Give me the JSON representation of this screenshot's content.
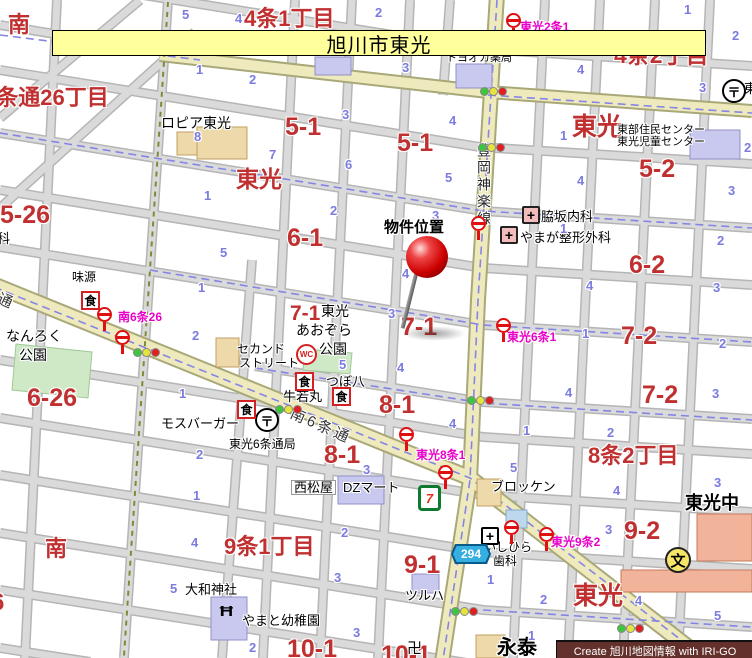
{
  "banner": {
    "title": "旭川市東光"
  },
  "credit_text": "Create 旭川地図情報 with IRI-GO",
  "marker": {
    "label": "物件位置"
  },
  "colors": {
    "area_red": "#c03030",
    "lot_blue": "#7b7be0",
    "busstop_magenta": "#e800c8",
    "banner_bg": "#ffff9c",
    "credit_bg": "#63302b",
    "road_yellow": "#efeabd"
  },
  "labels": [
    {
      "c": "red",
      "t": "南",
      "x": 8,
      "y": 14,
      "s": 22
    },
    {
      "c": "red",
      "t": "4条1丁目",
      "x": 244,
      "y": 8,
      "s": 22
    },
    {
      "c": "red",
      "t": "4条2丁目",
      "x": 614,
      "y": 44,
      "s": 23
    },
    {
      "c": "red",
      "t": "4条通26丁目",
      "x": -16,
      "y": 87,
      "s": 22
    },
    {
      "c": "red",
      "t": "5-26",
      "x": 0,
      "y": 203,
      "s": 25
    },
    {
      "c": "red",
      "t": "東光",
      "x": 236,
      "y": 168,
      "s": 23
    },
    {
      "c": "red",
      "t": "東光",
      "x": 572,
      "y": 115,
      "s": 25
    },
    {
      "c": "red",
      "t": "5-1",
      "x": 285,
      "y": 115,
      "s": 25
    },
    {
      "c": "red",
      "t": "5-1",
      "x": 397,
      "y": 131,
      "s": 25
    },
    {
      "c": "red",
      "t": "5-2",
      "x": 639,
      "y": 157,
      "s": 25
    },
    {
      "c": "red",
      "t": "6-1",
      "x": 287,
      "y": 226,
      "s": 25
    },
    {
      "c": "red",
      "t": "6-2",
      "x": 629,
      "y": 253,
      "s": 25
    },
    {
      "c": "red",
      "t": "6-26",
      "x": 27,
      "y": 386,
      "s": 25
    },
    {
      "c": "red",
      "t": "7-1",
      "x": 290,
      "y": 303,
      "s": 21
    },
    {
      "c": "red",
      "t": "7-1",
      "x": 401,
      "y": 315,
      "s": 25
    },
    {
      "c": "red",
      "t": "7-2",
      "x": 621,
      "y": 324,
      "s": 25
    },
    {
      "c": "red",
      "t": "7-2",
      "x": 642,
      "y": 383,
      "s": 25
    },
    {
      "c": "red",
      "t": "8-1",
      "x": 379,
      "y": 393,
      "s": 25
    },
    {
      "c": "red",
      "t": "8-1",
      "x": 324,
      "y": 443,
      "s": 25
    },
    {
      "c": "red",
      "t": "8条2丁目",
      "x": 588,
      "y": 445,
      "s": 22
    },
    {
      "c": "red",
      "t": "9条1丁目",
      "x": 224,
      "y": 536,
      "s": 22
    },
    {
      "c": "red",
      "t": "9-1",
      "x": 404,
      "y": 553,
      "s": 25
    },
    {
      "c": "red",
      "t": "9-2",
      "x": 624,
      "y": 519,
      "s": 25
    },
    {
      "c": "red",
      "t": "南",
      "x": 45,
      "y": 538,
      "s": 22
    },
    {
      "c": "red",
      "t": "東光",
      "x": 573,
      "y": 584,
      "s": 25
    },
    {
      "c": "red",
      "t": "10-1",
      "x": 287,
      "y": 637,
      "s": 25
    },
    {
      "c": "red",
      "t": "10-1",
      "x": 381,
      "y": 643,
      "s": 25
    },
    {
      "c": "red",
      "t": "6",
      "x": -9,
      "y": 591,
      "s": 24
    },
    {
      "c": "mag",
      "t": "東光2条1",
      "x": 520,
      "y": 21,
      "s": 12
    },
    {
      "c": "mag",
      "t": "南6条26",
      "x": 118,
      "y": 311,
      "s": 12
    },
    {
      "c": "mag",
      "t": "東光6条1",
      "x": 507,
      "y": 331,
      "s": 12
    },
    {
      "c": "mag",
      "t": "東光8条1",
      "x": 416,
      "y": 449,
      "s": 12
    },
    {
      "c": "mag",
      "t": "東光9条2",
      "x": 551,
      "y": 536,
      "s": 12
    },
    {
      "c": "poi",
      "t": "トヨオカ薬局",
      "x": 446,
      "y": 53,
      "s": 11
    },
    {
      "c": "poi",
      "t": "ロピア東光",
      "x": 161,
      "y": 116,
      "s": 14
    },
    {
      "c": "poi",
      "t": "東部住民センター",
      "x": 617,
      "y": 125,
      "s": 11
    },
    {
      "c": "poi",
      "t": "東光児童センター",
      "x": 617,
      "y": 137,
      "s": 11
    },
    {
      "c": "poi",
      "t": "脇坂内科",
      "x": 541,
      "y": 210,
      "s": 13
    },
    {
      "c": "poi",
      "t": "やまが整形外科",
      "x": 520,
      "y": 231,
      "s": 13
    },
    {
      "c": "poi",
      "t": "味源",
      "x": 72,
      "y": 271,
      "s": 12
    },
    {
      "c": "poi",
      "t": "なんろく",
      "x": 6,
      "y": 329,
      "s": 14
    },
    {
      "c": "poi",
      "t": "公園",
      "x": 19,
      "y": 348,
      "s": 14
    },
    {
      "c": "poi",
      "t": "東光",
      "x": 321,
      "y": 304,
      "s": 14
    },
    {
      "c": "poi",
      "t": "あおぞら",
      "x": 296,
      "y": 323,
      "s": 14
    },
    {
      "c": "poi",
      "t": "公園",
      "x": 319,
      "y": 342,
      "s": 14
    },
    {
      "c": "poi",
      "t": "セカンド",
      "x": 237,
      "y": 343,
      "s": 12
    },
    {
      "c": "poi",
      "t": "ストリート",
      "x": 239,
      "y": 357,
      "s": 12
    },
    {
      "c": "poi",
      "t": "つぼ八",
      "x": 326,
      "y": 375,
      "s": 13
    },
    {
      "c": "poi",
      "t": "牛若丸",
      "x": 283,
      "y": 390,
      "s": 13
    },
    {
      "c": "poi",
      "t": "モスバーガー",
      "x": 161,
      "y": 417,
      "s": 13
    },
    {
      "c": "poi",
      "t": "東光6条通局",
      "x": 229,
      "y": 438,
      "s": 12
    },
    {
      "c": "poi boxed",
      "t": "西松屋",
      "x": 291,
      "y": 480,
      "s": 13
    },
    {
      "c": "poi",
      "t": "DZマート",
      "x": 343,
      "y": 481,
      "s": 13
    },
    {
      "c": "poi",
      "t": "ブロッケン",
      "x": 491,
      "y": 480,
      "s": 13
    },
    {
      "c": "poi",
      "t": "いしひら",
      "x": 484,
      "y": 541,
      "s": 12
    },
    {
      "c": "poi",
      "t": "歯科",
      "x": 493,
      "y": 555,
      "s": 12
    },
    {
      "c": "poib",
      "t": "東光中",
      "x": 685,
      "y": 494,
      "s": 18
    },
    {
      "c": "poi",
      "t": "ツルハ",
      "x": 405,
      "y": 589,
      "s": 13
    },
    {
      "c": "poi",
      "t": "大和神社",
      "x": 185,
      "y": 583,
      "s": 13
    },
    {
      "c": "poi",
      "t": "やまと幼稚園",
      "x": 242,
      "y": 614,
      "s": 13
    },
    {
      "c": "poib",
      "t": "永泰",
      "x": 497,
      "y": 638,
      "s": 20
    },
    {
      "c": "poi",
      "t": "卍",
      "x": 407,
      "y": 641,
      "s": 15
    },
    {
      "c": "poi",
      "t": "科",
      "x": -3,
      "y": 232,
      "s": 13
    },
    {
      "c": "poi",
      "t": "東",
      "x": 744,
      "y": 82,
      "s": 13
    },
    {
      "c": "vroad",
      "t": "豊岡神楽線",
      "x": 477,
      "y": 143,
      "s": 14
    },
    {
      "c": "droad",
      "t": "南6条通",
      "x": 294,
      "y": 406,
      "s": 15,
      "r": 24
    },
    {
      "c": "droad",
      "t": "通",
      "x": 1,
      "y": 291,
      "s": 15,
      "r": 24
    },
    {
      "c": "blue",
      "t": "5",
      "x": 182,
      "y": 8,
      "s": 13
    },
    {
      "c": "blue",
      "t": "4",
      "x": 235,
      "y": 12,
      "s": 13
    },
    {
      "c": "blue",
      "t": "2",
      "x": 375,
      "y": 6,
      "s": 13
    },
    {
      "c": "blue",
      "t": "1",
      "x": 196,
      "y": 63,
      "s": 13
    },
    {
      "c": "blue",
      "t": "2",
      "x": 249,
      "y": 73,
      "s": 13
    },
    {
      "c": "blue",
      "t": "3",
      "x": 402,
      "y": 61,
      "s": 13
    },
    {
      "c": "blue",
      "t": "1",
      "x": 684,
      "y": 3,
      "s": 13
    },
    {
      "c": "blue",
      "t": "2",
      "x": 732,
      "y": 29,
      "s": 13
    },
    {
      "c": "blue",
      "t": "4",
      "x": 577,
      "y": 63,
      "s": 13
    },
    {
      "c": "blue",
      "t": "3",
      "x": 699,
      "y": 81,
      "s": 13
    },
    {
      "c": "blue",
      "t": "8",
      "x": 194,
      "y": 130,
      "s": 13
    },
    {
      "c": "blue",
      "t": "1",
      "x": 204,
      "y": 189,
      "s": 13
    },
    {
      "c": "blue",
      "t": "3",
      "x": 342,
      "y": 108,
      "s": 13
    },
    {
      "c": "blue",
      "t": "4",
      "x": 449,
      "y": 114,
      "s": 13
    },
    {
      "c": "blue",
      "t": "7",
      "x": 269,
      "y": 148,
      "s": 13
    },
    {
      "c": "blue",
      "t": "6",
      "x": 345,
      "y": 158,
      "s": 13
    },
    {
      "c": "blue",
      "t": "5",
      "x": 445,
      "y": 171,
      "s": 13
    },
    {
      "c": "blue",
      "t": "2",
      "x": 330,
      "y": 204,
      "s": 13
    },
    {
      "c": "blue",
      "t": "3",
      "x": 432,
      "y": 209,
      "s": 13
    },
    {
      "c": "blue",
      "t": "1",
      "x": 560,
      "y": 129,
      "s": 13
    },
    {
      "c": "blue",
      "t": "2",
      "x": 744,
      "y": 141,
      "s": 13
    },
    {
      "c": "blue",
      "t": "4",
      "x": 577,
      "y": 174,
      "s": 13
    },
    {
      "c": "blue",
      "t": "3",
      "x": 728,
      "y": 184,
      "s": 13
    },
    {
      "c": "blue",
      "t": "5",
      "x": 220,
      "y": 246,
      "s": 13
    },
    {
      "c": "blue",
      "t": "1",
      "x": 198,
      "y": 281,
      "s": 13
    },
    {
      "c": "blue",
      "t": "2",
      "x": 192,
      "y": 329,
      "s": 13
    },
    {
      "c": "blue",
      "t": "4",
      "x": 402,
      "y": 267,
      "s": 13
    },
    {
      "c": "blue",
      "t": "3",
      "x": 388,
      "y": 307,
      "s": 13
    },
    {
      "c": "blue",
      "t": "1",
      "x": 560,
      "y": 222,
      "s": 13
    },
    {
      "c": "blue",
      "t": "2",
      "x": 717,
      "y": 234,
      "s": 13
    },
    {
      "c": "blue",
      "t": "4",
      "x": 586,
      "y": 279,
      "s": 13
    },
    {
      "c": "blue",
      "t": "3",
      "x": 713,
      "y": 281,
      "s": 13
    },
    {
      "c": "blue",
      "t": "1",
      "x": 582,
      "y": 327,
      "s": 13
    },
    {
      "c": "blue",
      "t": "5",
      "x": 339,
      "y": 358,
      "s": 13
    },
    {
      "c": "blue",
      "t": "4",
      "x": 397,
      "y": 361,
      "s": 13
    },
    {
      "c": "blue",
      "t": "4",
      "x": 449,
      "y": 417,
      "s": 13
    },
    {
      "c": "blue",
      "t": "1",
      "x": 179,
      "y": 387,
      "s": 13
    },
    {
      "c": "blue",
      "t": "2",
      "x": 196,
      "y": 448,
      "s": 13
    },
    {
      "c": "blue",
      "t": "2",
      "x": 719,
      "y": 337,
      "s": 13
    },
    {
      "c": "blue",
      "t": "4",
      "x": 565,
      "y": 386,
      "s": 13
    },
    {
      "c": "blue",
      "t": "3",
      "x": 712,
      "y": 387,
      "s": 13
    },
    {
      "c": "blue",
      "t": "1",
      "x": 523,
      "y": 424,
      "s": 13
    },
    {
      "c": "blue",
      "t": "2",
      "x": 607,
      "y": 426,
      "s": 13
    },
    {
      "c": "blue",
      "t": "5",
      "x": 510,
      "y": 461,
      "s": 13
    },
    {
      "c": "blue",
      "t": "3",
      "x": 363,
      "y": 463,
      "s": 13
    },
    {
      "c": "blue",
      "t": "2",
      "x": 341,
      "y": 526,
      "s": 13
    },
    {
      "c": "blue",
      "t": "3",
      "x": 334,
      "y": 571,
      "s": 13
    },
    {
      "c": "blue",
      "t": "1",
      "x": 487,
      "y": 573,
      "s": 13
    },
    {
      "c": "blue",
      "t": "4",
      "x": 613,
      "y": 484,
      "s": 13
    },
    {
      "c": "blue",
      "t": "3",
      "x": 714,
      "y": 476,
      "s": 13
    },
    {
      "c": "blue",
      "t": "3",
      "x": 605,
      "y": 523,
      "s": 13
    },
    {
      "c": "blue",
      "t": "1",
      "x": 193,
      "y": 489,
      "s": 13
    },
    {
      "c": "blue",
      "t": "4",
      "x": 191,
      "y": 536,
      "s": 13
    },
    {
      "c": "blue",
      "t": "5",
      "x": 170,
      "y": 582,
      "s": 13
    },
    {
      "c": "blue",
      "t": "2",
      "x": 249,
      "y": 641,
      "s": 13
    },
    {
      "c": "blue",
      "t": "3",
      "x": 353,
      "y": 626,
      "s": 13
    },
    {
      "c": "blue",
      "t": "2",
      "x": 540,
      "y": 593,
      "s": 13
    },
    {
      "c": "blue",
      "t": "4",
      "x": 635,
      "y": 594,
      "s": 13
    },
    {
      "c": "blue",
      "t": "5",
      "x": 714,
      "y": 609,
      "s": 13
    },
    {
      "c": "blue",
      "t": "1",
      "x": 528,
      "y": 629,
      "s": 13
    }
  ],
  "icons": [
    {
      "k": "bus",
      "x": 506,
      "y": 13
    },
    {
      "k": "bus",
      "x": 97,
      "y": 307
    },
    {
      "k": "bus",
      "x": 115,
      "y": 330
    },
    {
      "k": "bus",
      "x": 496,
      "y": 318
    },
    {
      "k": "bus",
      "x": 399,
      "y": 427
    },
    {
      "k": "bus",
      "x": 438,
      "y": 465
    },
    {
      "k": "bus",
      "x": 539,
      "y": 527
    },
    {
      "k": "bus",
      "x": 504,
      "y": 520
    },
    {
      "k": "bus",
      "x": 471,
      "y": 216
    },
    {
      "k": "sig",
      "x": 480,
      "y": 87
    },
    {
      "k": "sig",
      "x": 478,
      "y": 143
    },
    {
      "k": "sig",
      "x": 133,
      "y": 348
    },
    {
      "k": "sig",
      "x": 275,
      "y": 405
    },
    {
      "k": "sig",
      "x": 467,
      "y": 396
    },
    {
      "k": "sig",
      "x": 451,
      "y": 607
    },
    {
      "k": "sig",
      "x": 617,
      "y": 624
    },
    {
      "k": "post",
      "t": "〒",
      "x": 722,
      "y": 79
    },
    {
      "k": "post",
      "t": "〒",
      "x": 255,
      "y": 408
    },
    {
      "k": "hosp",
      "t": "+",
      "x": 522,
      "y": 206
    },
    {
      "k": "hosp",
      "t": "+",
      "x": 500,
      "y": 226
    },
    {
      "k": "hospbw",
      "t": "+",
      "x": 481,
      "y": 527
    },
    {
      "k": "food",
      "t": "食",
      "x": 81,
      "y": 291
    },
    {
      "k": "food",
      "t": "食",
      "x": 295,
      "y": 372
    },
    {
      "k": "food",
      "t": "食",
      "x": 332,
      "y": 387
    },
    {
      "k": "food",
      "t": "食",
      "x": 237,
      "y": 400
    },
    {
      "k": "wc",
      "t": "WC",
      "x": 296,
      "y": 344
    },
    {
      "k": "seven",
      "t": "7",
      "x": 418,
      "y": 485
    },
    {
      "k": "school",
      "t": "文",
      "x": 665,
      "y": 547
    },
    {
      "k": "shield",
      "t": "294",
      "x": 451,
      "y": 544
    },
    {
      "k": "torii",
      "t": "Ħ",
      "x": 221,
      "y": 603
    }
  ]
}
